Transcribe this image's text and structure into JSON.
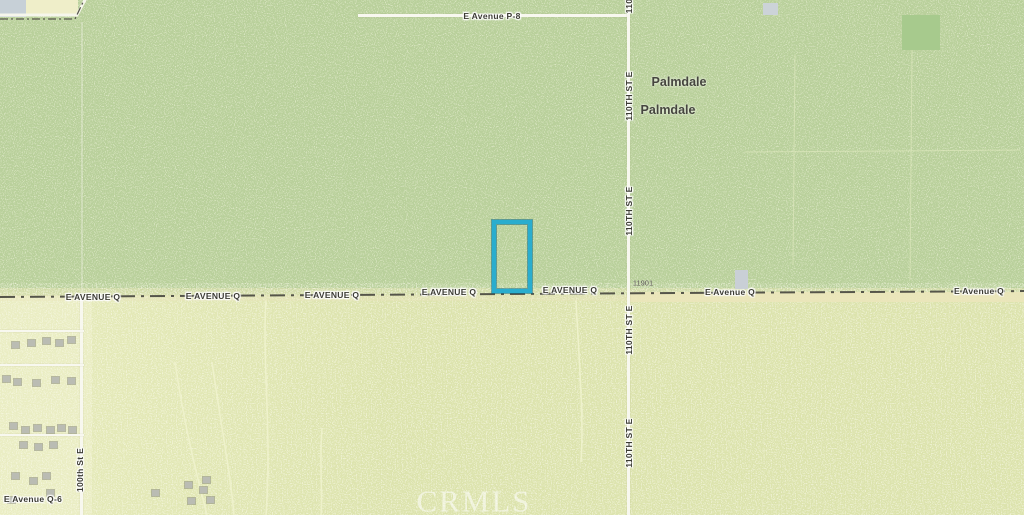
{
  "map": {
    "watermark": "CRMLS",
    "colors": {
      "north_bg": "#b9d09b",
      "south_bg": "#dce3ad",
      "residential_bg": "#eaedc3",
      "road": "#f8f8ef",
      "centerline": "#55554a",
      "pavement": "#ebe5ba",
      "parcel_stroke": "#2aadce"
    },
    "parcel": {
      "x": 492,
      "y": 220,
      "w": 40,
      "h": 73
    },
    "city_labels": [
      {
        "text": "Palmdale",
        "x": 679,
        "y": 82
      },
      {
        "text": "Palmdale",
        "x": 668,
        "y": 110
      }
    ],
    "street_labels": [
      {
        "text": "E Avenue P-8",
        "x": 492,
        "y": 16
      },
      {
        "text": "110",
        "x": 629,
        "y": 6,
        "rot": -90
      },
      {
        "text": "110TH ST E",
        "x": 629,
        "y": 96,
        "rot": -90
      },
      {
        "text": "110TH ST E",
        "x": 629,
        "y": 211,
        "rot": -90
      },
      {
        "text": "110TH ST E",
        "x": 629,
        "y": 330,
        "rot": -90
      },
      {
        "text": "110TH ST E",
        "x": 629,
        "y": 443,
        "rot": -90
      },
      {
        "text": "100th St E",
        "x": 80,
        "y": 470,
        "rot": -90
      },
      {
        "text": "E AVENUE Q",
        "x": 93,
        "y": 297
      },
      {
        "text": "E AVENUE Q",
        "x": 213,
        "y": 296
      },
      {
        "text": "E AVENUE Q",
        "x": 332,
        "y": 295
      },
      {
        "text": "E AVENUE Q",
        "x": 449,
        "y": 292
      },
      {
        "text": "E AVENUE Q",
        "x": 570,
        "y": 290
      },
      {
        "text": "E Avenue Q",
        "x": 730,
        "y": 292
      },
      {
        "text": "E Avenue Q",
        "x": 979,
        "y": 291
      },
      {
        "text": "E Avenue Q-6",
        "x": 33,
        "y": 499
      },
      {
        "text": "11901",
        "x": 643,
        "y": 283,
        "size": 7.5,
        "muted": true
      }
    ],
    "roads": [
      {
        "name": "road-e-avenue-p8",
        "x": 358,
        "y": 14,
        "w": 270,
        "h": 3
      },
      {
        "name": "road-110th-st-e",
        "x": 627,
        "y": 0,
        "w": 3,
        "h": 515
      },
      {
        "name": "road-100th-st-e",
        "x": 80,
        "y": 298,
        "w": 3,
        "h": 217
      },
      {
        "name": "road-100th-st-e-trace",
        "x": 81,
        "y": 22,
        "w": 2,
        "h": 272,
        "o": 0.3
      },
      {
        "name": "road-residential-1",
        "x": 0,
        "y": 330,
        "w": 84,
        "h": 2
      },
      {
        "name": "road-residential-2",
        "x": 0,
        "y": 364,
        "w": 84,
        "h": 2
      },
      {
        "name": "road-residential-3",
        "x": 0,
        "y": 434,
        "w": 84,
        "h": 2
      }
    ],
    "patches": [
      {
        "name": "city-area-gray-patch",
        "x": 0,
        "y": 0,
        "w": 26,
        "h": 17,
        "c": "#c7d0d7"
      },
      {
        "name": "field-patch-yellow",
        "x": 26,
        "y": 0,
        "w": 52,
        "h": 14,
        "c": "#efeec9"
      },
      {
        "name": "building-footprint",
        "x": 763,
        "y": 3,
        "w": 15,
        "h": 12,
        "c": "#ccd3d8"
      },
      {
        "name": "green-parcel-patch",
        "x": 902,
        "y": 15,
        "w": 38,
        "h": 35,
        "c": "#a7ca8d"
      },
      {
        "name": "building-footprint",
        "x": 735,
        "y": 270,
        "w": 13,
        "h": 19,
        "c": "#c9cfd6"
      }
    ],
    "houses": [
      [
        12,
        342
      ],
      [
        28,
        340
      ],
      [
        43,
        338
      ],
      [
        56,
        340
      ],
      [
        68,
        337
      ],
      [
        3,
        376
      ],
      [
        14,
        379
      ],
      [
        33,
        380
      ],
      [
        52,
        377
      ],
      [
        68,
        378
      ],
      [
        10,
        423
      ],
      [
        22,
        427
      ],
      [
        34,
        425
      ],
      [
        47,
        427
      ],
      [
        58,
        425
      ],
      [
        69,
        427
      ],
      [
        20,
        442
      ],
      [
        35,
        444
      ],
      [
        50,
        442
      ],
      [
        12,
        473
      ],
      [
        30,
        478
      ],
      [
        43,
        473
      ],
      [
        8,
        497
      ],
      [
        47,
        490
      ],
      [
        152,
        490
      ],
      [
        185,
        482
      ],
      [
        200,
        487
      ],
      [
        207,
        497
      ],
      [
        188,
        498
      ],
      [
        203,
        477
      ]
    ]
  }
}
